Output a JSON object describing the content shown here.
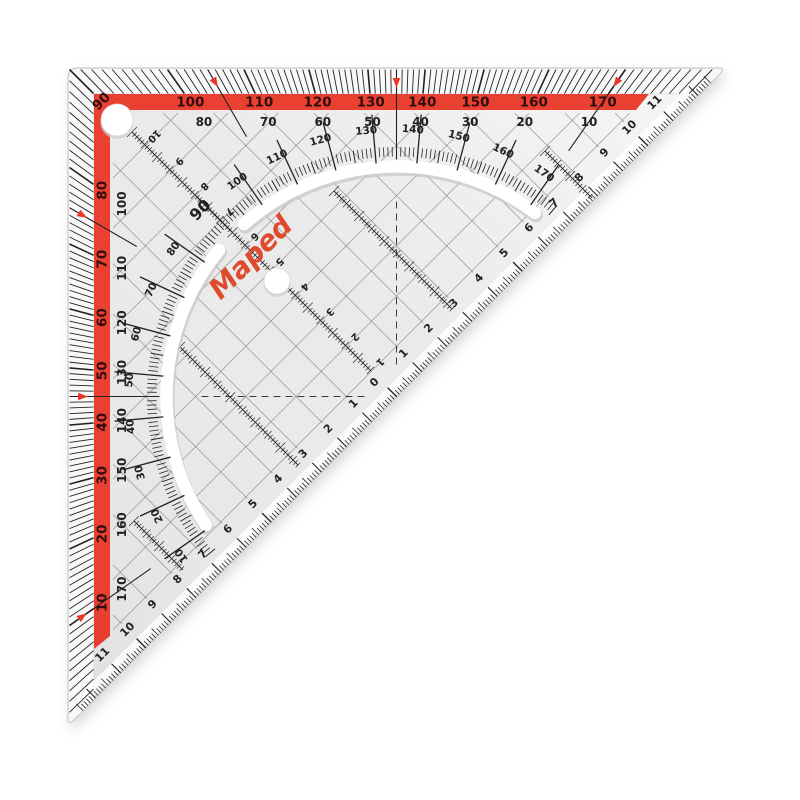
{
  "product": {
    "brand": "Maped",
    "item": "transparent protractor set square"
  },
  "colors": {
    "band_red": "#e8392b",
    "logo_red": "#df4a2e",
    "ink": "#232020",
    "band_digit": "#30100d",
    "body_gray": "#eaeaea"
  },
  "protractor": {
    "corner_label": "90",
    "band_top": [
      "100",
      "110",
      "120",
      "130",
      "140",
      "150",
      "160",
      "170"
    ],
    "band_left": [
      "80",
      "70",
      "60",
      "50",
      "40",
      "30",
      "20",
      "10"
    ],
    "complement_top": [
      "80",
      "70",
      "60",
      "50",
      "40",
      "30",
      "20",
      "10"
    ],
    "complement_left": [
      "100",
      "110",
      "120",
      "130",
      "140",
      "150",
      "160",
      "170"
    ],
    "arc": [
      "10",
      "20",
      "30",
      "40",
      "50",
      "60",
      "70",
      "80",
      "90",
      "100",
      "110",
      "120",
      "130",
      "140",
      "150",
      "160",
      "170"
    ],
    "marker_degrees": [
      10,
      45,
      75,
      105,
      135,
      170
    ]
  },
  "rulers": {
    "hyp_zero": "0",
    "hyp_toward_tip_right": [
      "1",
      "2",
      "3",
      "4",
      "5",
      "6",
      "7",
      "8",
      "9",
      "10",
      "11"
    ],
    "hyp_toward_tip_left": [
      "1",
      "2",
      "3",
      "4",
      "5",
      "6",
      "7",
      "8",
      "9",
      "10",
      "11"
    ],
    "height_axis": [
      "1",
      "2",
      "3",
      "4",
      "5",
      "6",
      "7",
      "8",
      "9",
      "10"
    ]
  }
}
